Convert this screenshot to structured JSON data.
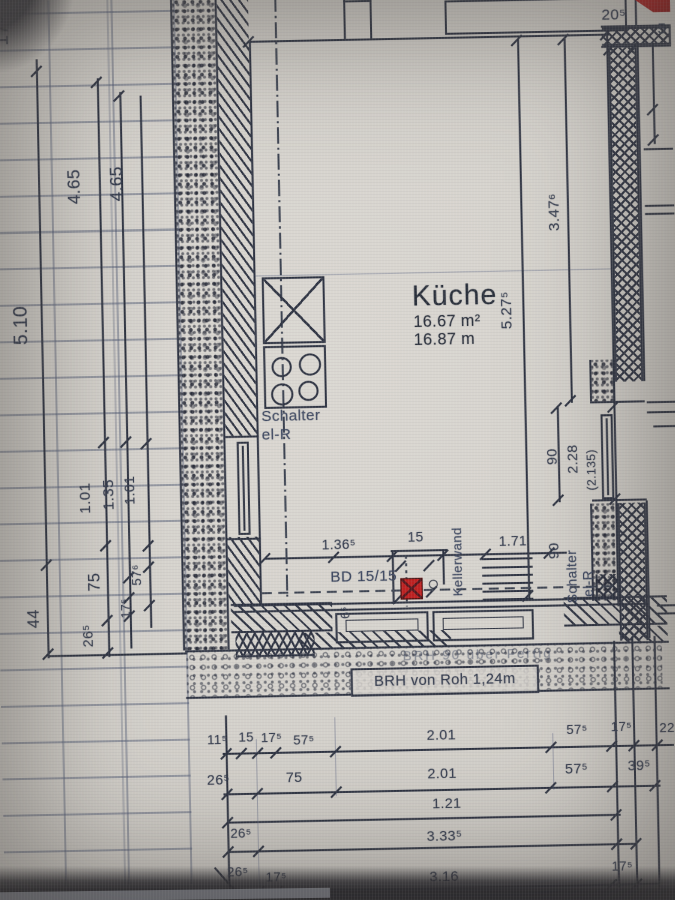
{
  "meta": {
    "description": "Photo of an architectural floor plan of a kitchen (basement level), German annotations",
    "paper_color": "#d6d3cd",
    "ink_color": "#2b3140",
    "annotation_blue": "#3b4660",
    "red_marker_color": "#c01d1d"
  },
  "room": {
    "name": "Küche",
    "area": "16.67 m²",
    "line2": "16.87 m"
  },
  "texts": {
    "schalter1": "Schalter",
    "schalter2": "el-R",
    "bd": "BD 15/15",
    "kellerwand": "Kellerwand",
    "brh_faint": "BRH 90 über Fertig",
    "brh_box": "BRH von Roh 1,24m"
  },
  "dims": [
    {
      "t": "17⁵",
      "x": 5,
      "y": 44,
      "r": 1,
      "s": 19
    },
    {
      "t": "4.65",
      "x": 74,
      "y": 202,
      "r": 1,
      "s": 17
    },
    {
      "t": "4.65",
      "x": 116,
      "y": 200,
      "r": 1,
      "s": 17
    },
    {
      "t": "5.10",
      "x": 18,
      "y": 340,
      "r": 1,
      "s": 19
    },
    {
      "t": "1.01",
      "x": 80,
      "y": 508,
      "r": 1,
      "s": 15
    },
    {
      "t": "1.35",
      "x": 103,
      "y": 505,
      "r": 1,
      "s": 15
    },
    {
      "t": "1.01",
      "x": 124,
      "y": 500,
      "r": 1,
      "s": 14
    },
    {
      "t": "75",
      "x": 88,
      "y": 585,
      "r": 1,
      "s": 16
    },
    {
      "t": "57⁶",
      "x": 130,
      "y": 580,
      "r": 1,
      "s": 13
    },
    {
      "t": "44",
      "x": 27,
      "y": 620,
      "r": 1,
      "s": 16
    },
    {
      "t": "26⁵",
      "x": 80,
      "y": 640,
      "r": 1,
      "s": 14
    },
    {
      "t": "17⁵",
      "x": 119,
      "y": 612,
      "r": 1,
      "s": 12
    },
    {
      "t": "5.27⁵",
      "x": 500,
      "y": 334,
      "r": 1,
      "s": 15
    },
    {
      "t": "3.47⁶",
      "x": 549,
      "y": 238,
      "r": 1,
      "s": 15
    },
    {
      "t": "90",
      "x": 542,
      "y": 469,
      "r": 1,
      "s": 14
    },
    {
      "t": "2.28",
      "x": 562,
      "y": 478,
      "r": 1,
      "s": 14
    },
    {
      "t": "(2.135)",
      "x": 582,
      "y": 495,
      "r": 1,
      "s": 12
    },
    {
      "t": "90",
      "x": 542,
      "y": 562,
      "r": 1,
      "s": 14
    },
    {
      "t": "6⁵",
      "x": 336,
      "y": 617,
      "r": 1,
      "s": 12
    },
    {
      "t": "20⁵",
      "x": 607,
      "y": 18,
      "s": 15
    },
    {
      "t": "5",
      "x": 662,
      "y": 33,
      "s": 15
    },
    {
      "t": "1.36⁵",
      "x": 320,
      "y": 537,
      "s": 13.5
    },
    {
      "t": "15",
      "x": 405,
      "y": 531,
      "s": 13.5
    },
    {
      "t": "1.71",
      "x": 495,
      "y": 537,
      "s": 13.5
    },
    {
      "t": "11⁵",
      "x": 203,
      "y": 727,
      "s": 13
    },
    {
      "t": "15",
      "x": 234,
      "y": 725,
      "s": 13
    },
    {
      "t": "17⁵",
      "x": 256,
      "y": 726,
      "s": 13
    },
    {
      "t": "57⁵",
      "x": 288,
      "y": 729,
      "s": 13
    },
    {
      "t": "2.01",
      "x": 420,
      "y": 726,
      "s": 14
    },
    {
      "t": "57⁵",
      "x": 558,
      "y": 724,
      "s": 13
    },
    {
      "t": "17⁵",
      "x": 602,
      "y": 722,
      "s": 13
    },
    {
      "t": "22",
      "x": 650,
      "y": 724,
      "s": 13
    },
    {
      "t": "26⁵",
      "x": 202,
      "y": 766,
      "s": 14
    },
    {
      "t": "75",
      "x": 280,
      "y": 765,
      "s": 14
    },
    {
      "t": "2.01",
      "x": 420,
      "y": 764,
      "s": 14
    },
    {
      "t": "57⁵",
      "x": 556,
      "y": 762,
      "s": 14
    },
    {
      "t": "39⁵",
      "x": 618,
      "y": 760,
      "s": 14
    },
    {
      "t": "1.21",
      "x": 424,
      "y": 794,
      "s": 14
    },
    {
      "t": "26⁵",
      "x": 224,
      "y": 820,
      "s": 13
    },
    {
      "t": "3.33⁵",
      "x": 418,
      "y": 826,
      "s": 14
    },
    {
      "t": "26⁵",
      "x": 220,
      "y": 858,
      "s": 13
    },
    {
      "t": "17⁵",
      "x": 258,
      "y": 864,
      "s": 13
    },
    {
      "t": "3.16",
      "x": 420,
      "y": 866,
      "s": 14
    },
    {
      "t": "17⁵",
      "x": 600,
      "y": 860,
      "s": 13
    }
  ]
}
